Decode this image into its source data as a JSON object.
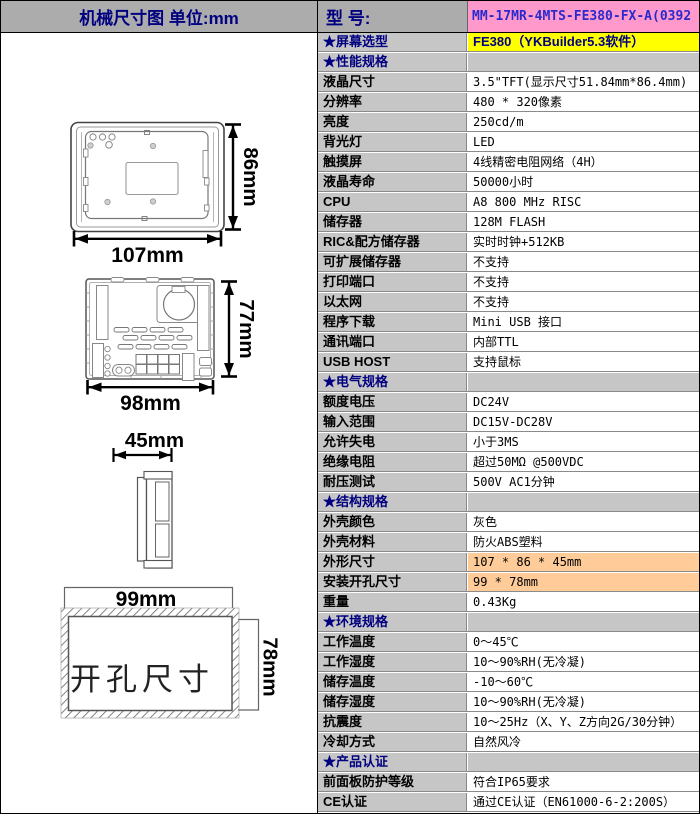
{
  "header": {
    "left_title": "机械尺寸图  单位:mm",
    "model_label": "型  号:",
    "model_value": "MM-17MR-4MTS-FE380-FX-A(0392"
  },
  "diagram": {
    "front": {
      "width": "107mm",
      "height": "86mm"
    },
    "rear": {
      "width": "98mm",
      "height": "77mm"
    },
    "side": {
      "depth": "45mm"
    },
    "cutout": {
      "width": "99mm",
      "height": "78mm",
      "caption": "开孔尺寸"
    }
  },
  "table": {
    "colors": {
      "label_bg": "#c6c6c6",
      "header_bg": "#acacac",
      "model_bg": "#ff99cc",
      "highlight_bg": "#ffff00",
      "orange_bg": "#ffcc99",
      "category_text": "#000080",
      "model_text": "#2a2acc"
    },
    "rows": [
      {
        "type": "highlight",
        "label": "★屏幕选型",
        "value": "FE380（YKBuilder5.3软件）"
      },
      {
        "type": "category",
        "label": "★性能规格",
        "value": ""
      },
      {
        "type": "normal",
        "label": "液晶尺寸",
        "value": "3.5\"TFT(显示尺寸51.84mm*86.4mm)"
      },
      {
        "type": "normal",
        "label": "分辨率",
        "value": "480 * 320像素"
      },
      {
        "type": "normal",
        "label": "亮度",
        "value": "250cd/m"
      },
      {
        "type": "normal",
        "label": "背光灯",
        "value": "LED"
      },
      {
        "type": "normal",
        "label": "触摸屏",
        "value": "4线精密电阻网络（4H）"
      },
      {
        "type": "normal",
        "label": "液晶寿命",
        "value": "50000小时"
      },
      {
        "type": "normal",
        "label": "CPU",
        "value": "A8 800 MHz RISC"
      },
      {
        "type": "normal",
        "label": "储存器",
        "value": "128M FLASH"
      },
      {
        "type": "normal",
        "label": "RIC&配方储存器",
        "value": "实时时钟+512KB"
      },
      {
        "type": "normal",
        "label": "可扩展储存器",
        "value": "不支持"
      },
      {
        "type": "normal",
        "label": "打印端口",
        "value": "不支持"
      },
      {
        "type": "normal",
        "label": "以太网",
        "value": "不支持"
      },
      {
        "type": "normal",
        "label": "程序下载",
        "value": "Mini USB 接口"
      },
      {
        "type": "normal",
        "label": "通讯端口",
        "value": "内部TTL"
      },
      {
        "type": "normal",
        "label": "USB HOST",
        "value": "支持鼠标"
      },
      {
        "type": "category",
        "label": "★电气规格",
        "value": ""
      },
      {
        "type": "normal",
        "label": "额度电压",
        "value": "DC24V"
      },
      {
        "type": "normal",
        "label": "输入范围",
        "value": "DC15V-DC28V"
      },
      {
        "type": "normal",
        "label": "允许失电",
        "value": "小于3MS"
      },
      {
        "type": "normal",
        "label": "绝缘电阻",
        "value": "超过50MΩ @500VDC"
      },
      {
        "type": "normal",
        "label": "耐压测试",
        "value": "500V AC1分钟"
      },
      {
        "type": "category",
        "label": "★结构规格",
        "value": ""
      },
      {
        "type": "normal",
        "label": "外壳颜色",
        "value": "灰色"
      },
      {
        "type": "normal",
        "label": "外壳材料",
        "value": "防火ABS塑料"
      },
      {
        "type": "orange",
        "label": "外形尺寸",
        "value": "107 * 86 * 45mm"
      },
      {
        "type": "orange",
        "label": "安装开孔尺寸",
        "value": "99 * 78mm"
      },
      {
        "type": "normal",
        "label": "重量",
        "value": "0.43Kg"
      },
      {
        "type": "category",
        "label": "★环境规格",
        "value": ""
      },
      {
        "type": "normal",
        "label": "工作温度",
        "value": "0～45℃"
      },
      {
        "type": "normal",
        "label": "工作湿度",
        "value": "10～90%RH(无冷凝)"
      },
      {
        "type": "normal",
        "label": "储存温度",
        "value": "-10～60℃"
      },
      {
        "type": "normal",
        "label": "储存湿度",
        "value": "10～90%RH(无冷凝)"
      },
      {
        "type": "normal",
        "label": "抗震度",
        "value": "10～25Hz（X、Y、Z方向2G/30分钟）"
      },
      {
        "type": "normal",
        "label": "冷却方式",
        "value": "自然风冷"
      },
      {
        "type": "category",
        "label": "★产品认证",
        "value": ""
      },
      {
        "type": "normal",
        "label": "前面板防护等级",
        "value": "符合IP65要求"
      },
      {
        "type": "normal",
        "label": "CE认证",
        "value": "通过CE认证（EN61000-6-2:200S）"
      }
    ]
  }
}
